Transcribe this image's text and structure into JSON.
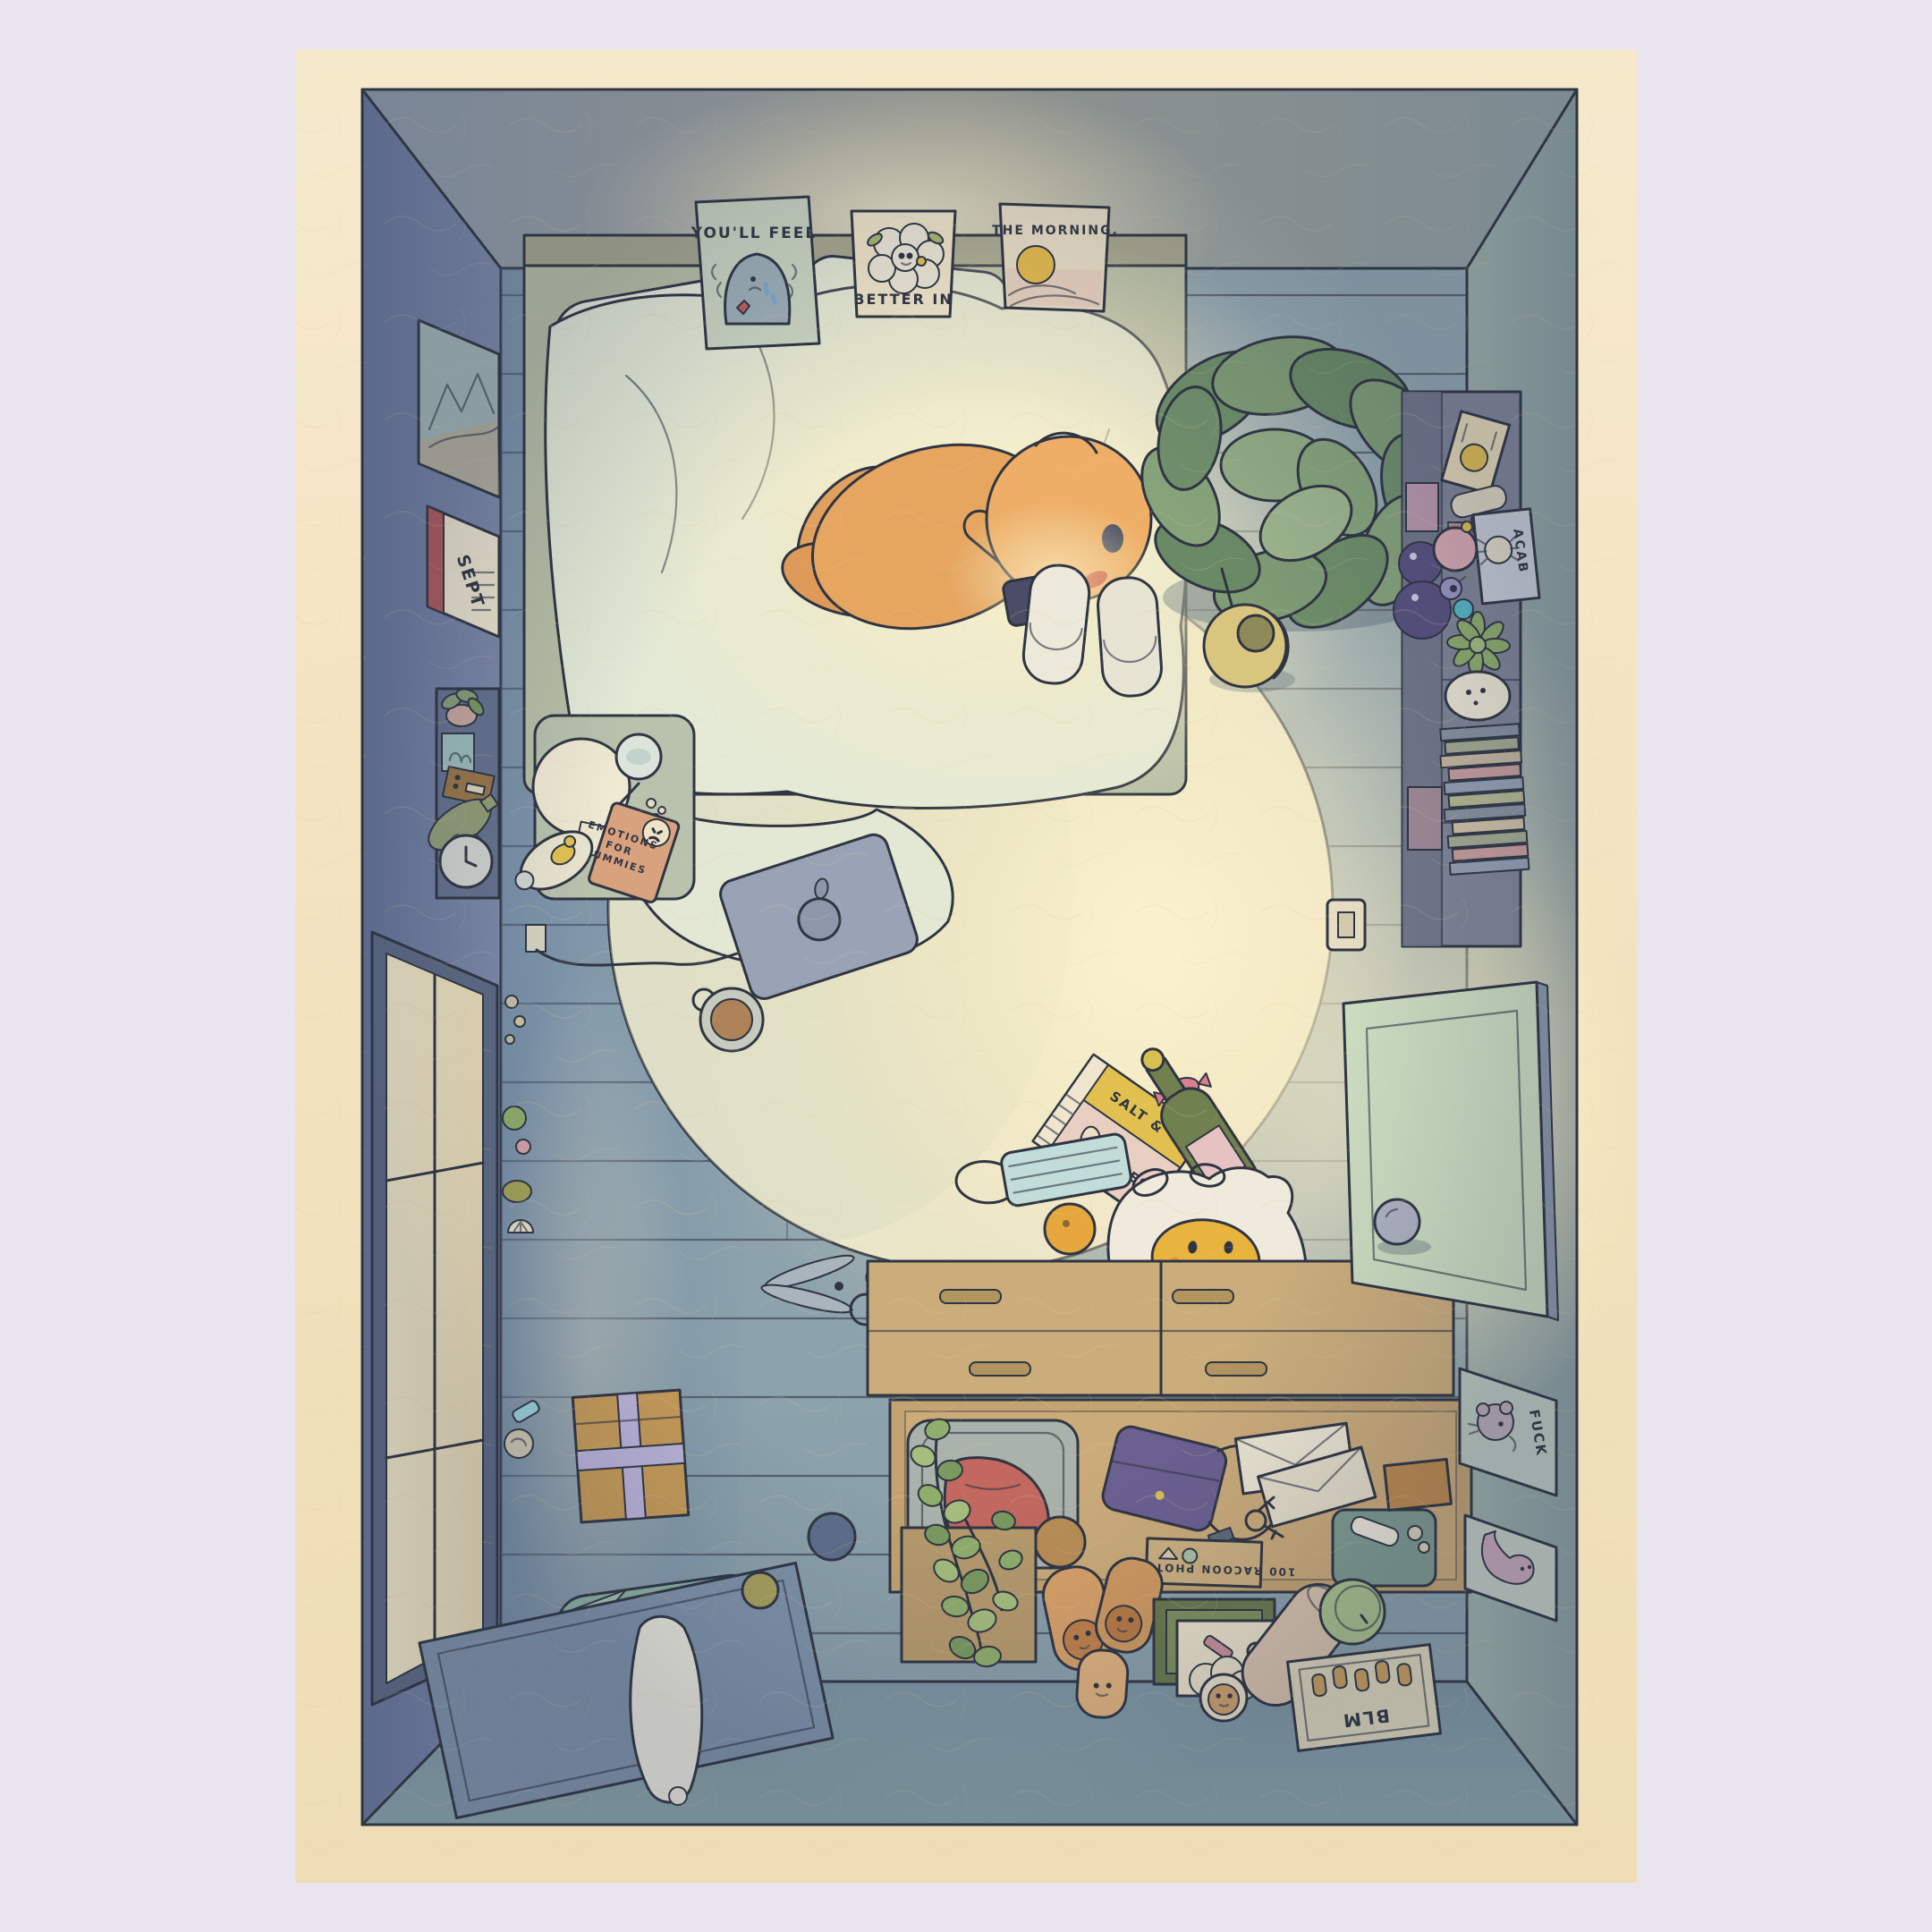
{
  "artwork": {
    "scene": "Top-down illustrated bedroom at night; a person lies curled in bed with their face lit by a phone, surrounded by cozy clutter, a round rug, a dresser with an open drawer, a glowing window and an open door.",
    "posters": [
      {
        "text": "YOU'LL FEEL",
        "subject": "crying blob"
      },
      {
        "text": "BETTER IN",
        "subject": "bouquet of flowers with tiny faces"
      },
      {
        "text": "THE MORNING.",
        "subject": "sun rising over hills"
      }
    ],
    "texts": {
      "calendar": "SEPT",
      "book": [
        "EMOTIONS",
        "FOR",
        "DUMMIES"
      ],
      "chips": [
        "SALT &",
        "SADNESS"
      ],
      "grocery_bag": "OH NO",
      "crab_print": "ACAB",
      "rat_print": "FUCK",
      "fist_frame": "BLM",
      "photo_box": "100 RACOON PHOTOS"
    },
    "objects": [
      "bed with pillows and duvet",
      "person holding glowing phone",
      "large leafy plant",
      "three wall prints",
      "framed landscape",
      "wall calendar",
      "wall shelf with radio, bottle, clock, plant, photo",
      "nightstand with ball lamp, water glass, pen, pills, sticky note, self-help book, infused water bottle",
      "window glowing warm with sill trinkets",
      "power outlet and laptop charging cable",
      "closed laptop with fruit logo",
      "mug",
      "round rug",
      "pair of slippers",
      "kettle",
      "chip bag",
      "wrapped candy",
      "wine bottle",
      "face mask",
      "orange",
      "plastic grocery bag with smiley",
      "receipt",
      "scissors",
      "wrapped gift box",
      "floor cushion",
      "small rug with plush toy",
      "hacky sack balls",
      "dresser with open drawer: laundry basket with red cloth, purse, envelopes, keys, usb stick, photo box, toiletry pouch",
      "trailing potted vine",
      "potato plushies with faces",
      "stacked picture frames with lipstick and rings",
      "sheep plush",
      "bolster pillow",
      "green can",
      "framed raised-fist print",
      "tall shelf with snacks, perfume, crab print, succulent, trinkets and stacked books",
      "light switch",
      "open door",
      "small ball",
      "rat print",
      "sock print"
    ],
    "palette": {
      "margin": "#e8e5ef",
      "paper": "#f2e4c2",
      "ink": "#2f3542",
      "wall_left": "#75829f",
      "wall_right": "#9cafa8",
      "floor": "#8ea3ad",
      "rug": "#e9e5cb",
      "bedding": "#e4ead6",
      "skin": "#e6a660",
      "phone_glow": "#fdf4cf",
      "dresser": "#cbad7b",
      "door": "#ccdcc0",
      "plant": "#7f9c74"
    }
  }
}
